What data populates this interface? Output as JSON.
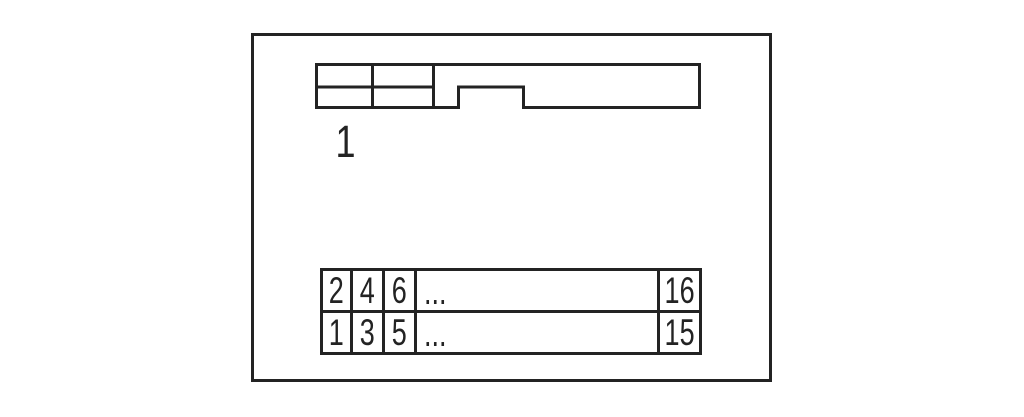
{
  "colors": {
    "line": "#232323",
    "background": "#ffffff"
  },
  "diagram": {
    "pin1_marker": "1",
    "pin_table": {
      "rows": [
        [
          "2",
          "4",
          "6",
          "...",
          "16"
        ],
        [
          "1",
          "3",
          "5",
          "...",
          "15"
        ]
      ]
    }
  }
}
